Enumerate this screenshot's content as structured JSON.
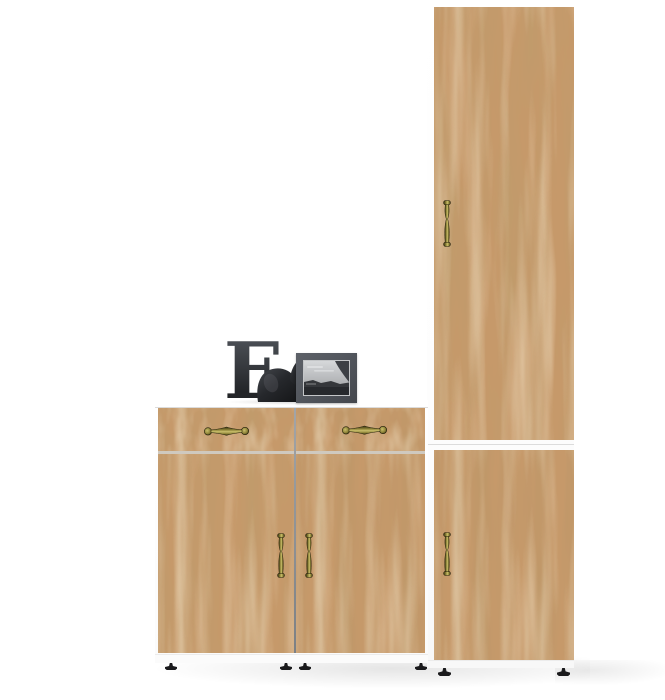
{
  "scene": {
    "type": "furniture-product-render",
    "description": "Hallway furniture set in craft oak finish: a tall two-door cabinet column on the right and a wide chest with two drawers and two doors, decorated with a letter ornament, a black figurine and a black-and-white photo frame",
    "background": "#ffffff"
  },
  "palette": {
    "wood_base": "#c6996a",
    "carcass_white": "#ffffff",
    "carcass_line": "#dcdcdc",
    "gap_dark": "#7c8084",
    "gap_light": "#cfc9bf",
    "brass_dark": "#35300f",
    "brass_mid": "#8d8338",
    "brass_light": "#cabf6b",
    "foot_black": "#1a1a1c",
    "decor_dark": "#232528",
    "decor_light": "#4a4e54",
    "frame_gray": "#53575e",
    "photo_sky": "#d6d8da",
    "photo_dark": "#35373b"
  },
  "decor": {
    "letter": "E",
    "figurine": "black bird figurine",
    "frame_photo": "black and white seascape"
  },
  "furniture": {
    "tall_cabinet": {
      "doors": 2,
      "handle_style": "antique brass"
    },
    "chest": {
      "drawers": 2,
      "doors": 2,
      "handle_style": "antique brass"
    }
  }
}
